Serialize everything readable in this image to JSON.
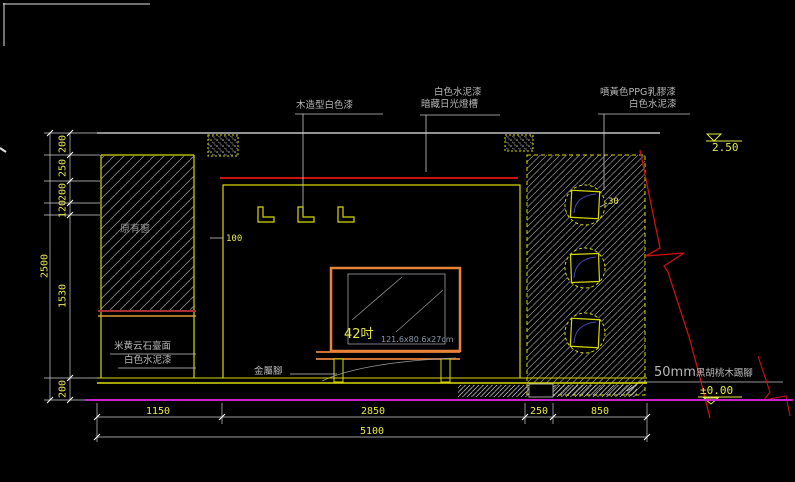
{
  "labels": {
    "wood_trim": "木造型白色漆",
    "cement_paint_top": "白色水泥漆",
    "hidden_light": "暗藏日光燈槽",
    "ppg_paint": "噴黃色PPG乳膠漆",
    "cement_paint_right": "白色水泥漆",
    "existing_window": "原有窗",
    "marble_top": "米黄云石臺面",
    "cement_paint_left": "白色水泥漆",
    "metal_feet": "金屬腳",
    "skirting_size": "50mm",
    "skirting_material": "黑胡桃木踢腳",
    "tv_size": "42吋",
    "tv_spec": "121.6x80.6x27cm"
  },
  "dims": {
    "v_chain": [
      "200",
      "250",
      "200",
      "120",
      "1530",
      "200"
    ],
    "v_total": "2500",
    "recess_depth": "100",
    "niche_depth": "30",
    "h_chain": [
      "1150",
      "2850",
      "250",
      "850"
    ],
    "h_total": "5100",
    "level_top": "2.50",
    "level_floor": "±0.00"
  },
  "colors": {
    "dim_text": "#e8e84a",
    "line_yellow": "#d8d800",
    "line_white": "#e0e0e0",
    "line_red": "#cc1111",
    "sill_red": "#a83232",
    "tv_orange": "#e8833a",
    "floor_magenta": "#c723c7",
    "note_gray": "#b8b8b8"
  }
}
